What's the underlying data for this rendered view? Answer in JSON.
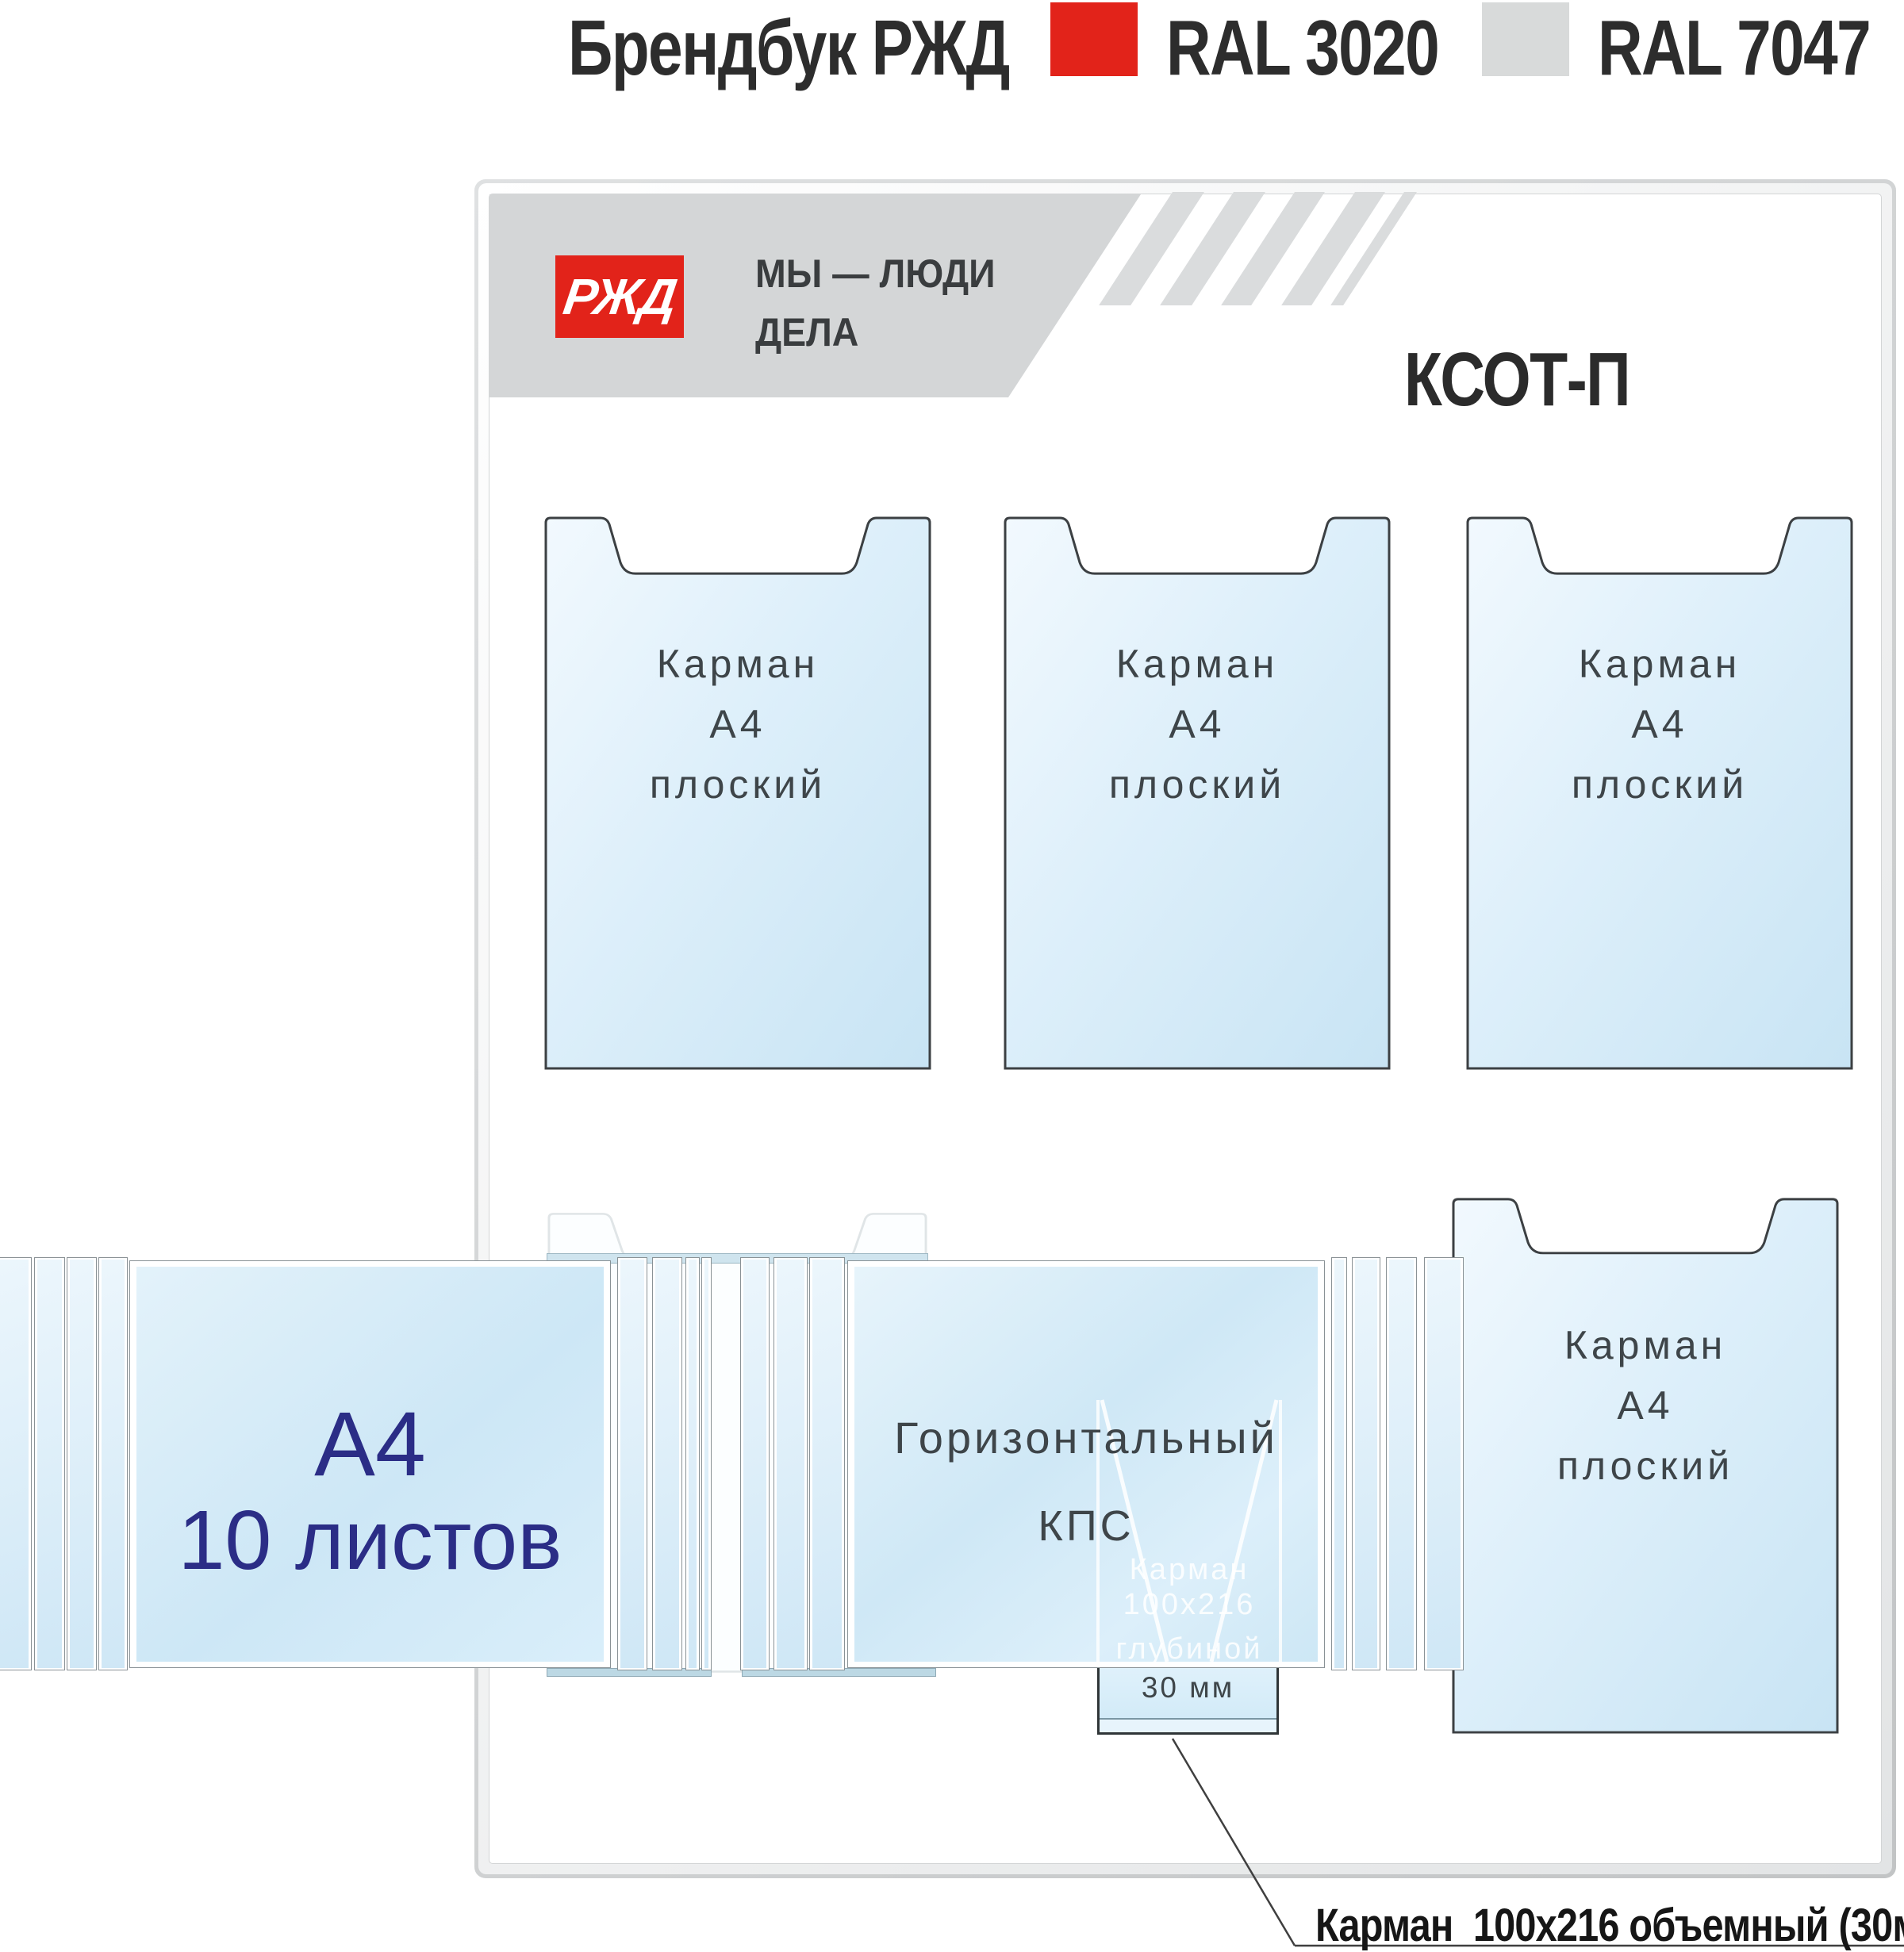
{
  "header": {
    "title": "Брендбук РЖД",
    "swatches": [
      {
        "label": "RAL 3020",
        "color": "#e2231a"
      },
      {
        "label": "RAL 7047",
        "color": "#d8dada"
      }
    ]
  },
  "banner": {
    "logo_text": "РЖД",
    "slogan_line1": "МЫ — ЛЮДИ",
    "slogan_line2": "ДЕЛА"
  },
  "board": {
    "title": "КСОТ-П"
  },
  "pockets": {
    "flat": [
      {
        "lines": [
          "Карман",
          "А4",
          "плоский"
        ]
      },
      {
        "lines": [
          "Карман",
          "А4",
          "плоский"
        ]
      },
      {
        "lines": [
          "Карман",
          "А4",
          "плоский"
        ]
      },
      {
        "lines": [
          "Карман",
          "А4",
          "плоский"
        ]
      }
    ]
  },
  "flipbook": {
    "sheet_line1": "А4",
    "sheet_line2": "10 листов"
  },
  "kps": {
    "line1": "Горизонтальный",
    "line2": "КПС"
  },
  "hidden_pocket": {
    "watermark_line1": "Карман",
    "watermark_line2": "100х216",
    "watermark_line3": "глубиной",
    "depth_label": "30 мм"
  },
  "callout": {
    "label": "Карман  100х216 объемный (30мм)"
  },
  "colors": {
    "accent_red": "#e2231a",
    "swatch_gray": "#d8dada",
    "pocket_blue": "#cfe7f6",
    "navy_text": "#2b2d86"
  }
}
